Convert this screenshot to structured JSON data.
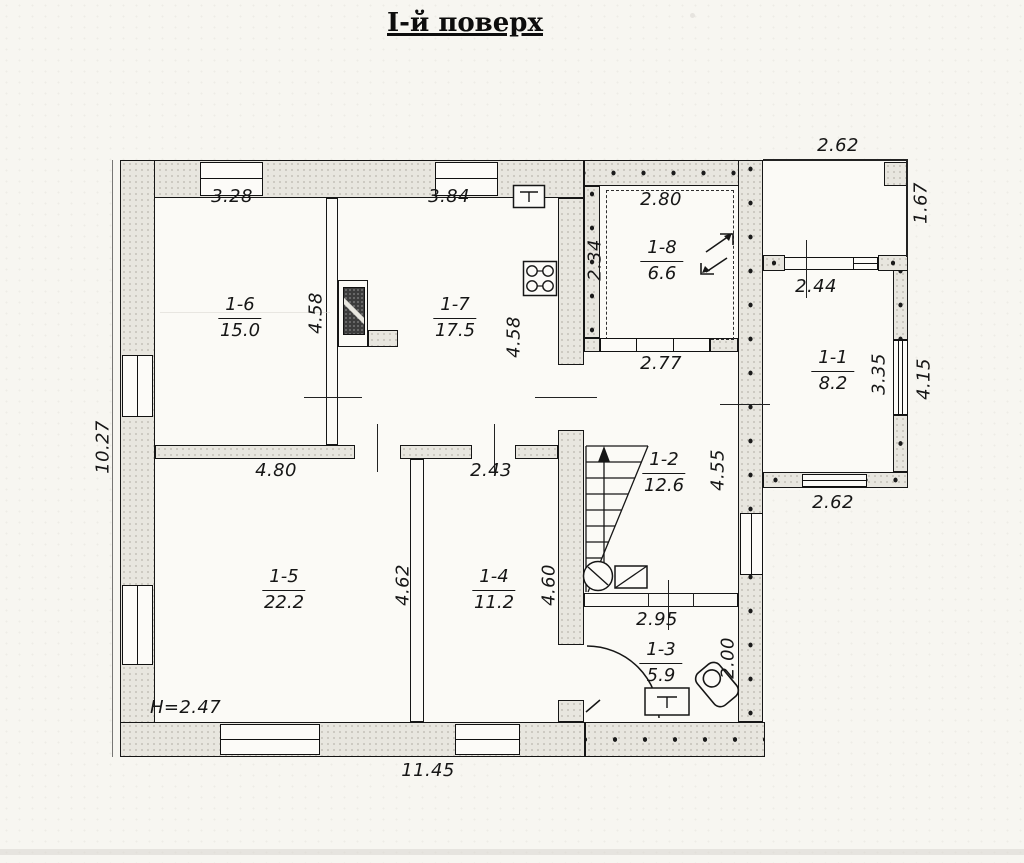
{
  "title": "І-й поверх",
  "rooms": {
    "r11": {
      "id": "1-1",
      "area": "8.2"
    },
    "r12": {
      "id": "1-2",
      "area": "12.6"
    },
    "r13": {
      "id": "1-3",
      "area": "5.9"
    },
    "r14": {
      "id": "1-4",
      "area": "11.2"
    },
    "r15": {
      "id": "1-5",
      "area": "22.2"
    },
    "r16": {
      "id": "1-6",
      "area": "15.0"
    },
    "r17": {
      "id": "1-7",
      "area": "17.5"
    },
    "r18": {
      "id": "1-8",
      "area": "6.6"
    }
  },
  "dims": {
    "top_room16": "3.28",
    "top_room17": "3.84",
    "room18_width": "2.80",
    "terrace_width": "2.62",
    "terrace_depth": "1.67",
    "room18_depth": "2.34",
    "room11_door": "2.44",
    "room18_bottom": "2.77",
    "room16_depth": "4.58",
    "room17_depth": "4.58",
    "hall_depth": "4.55",
    "left_total": "10.27",
    "room15_width": "4.80",
    "room14_width": "2.43",
    "room15_depth": "4.62",
    "room14_depth": "4.60",
    "bath_width": "2.95",
    "bath_depth": "2.00",
    "room11_depth": "3.35",
    "room11_depth_outer": "4.15",
    "room11_bottom": "2.62",
    "bottom_total": "11.45"
  },
  "notes": {
    "ceiling_height": "H=2.47"
  },
  "icons": {
    "stairs": "stairs-icon",
    "stove": "stove-icon",
    "kitchen_sink": "sink-icon",
    "bath_sink": "sink-icon",
    "toilet": "toilet-icon",
    "boiler": "boiler-icon",
    "chimney": "chimney-icon",
    "opening_arrows": "opening-arrows-icon",
    "door_arc": "door-arc-icon"
  },
  "colors": {
    "ink": "#161616",
    "wall_fill": "#e8e6df",
    "paper": "#f7f6f1"
  }
}
